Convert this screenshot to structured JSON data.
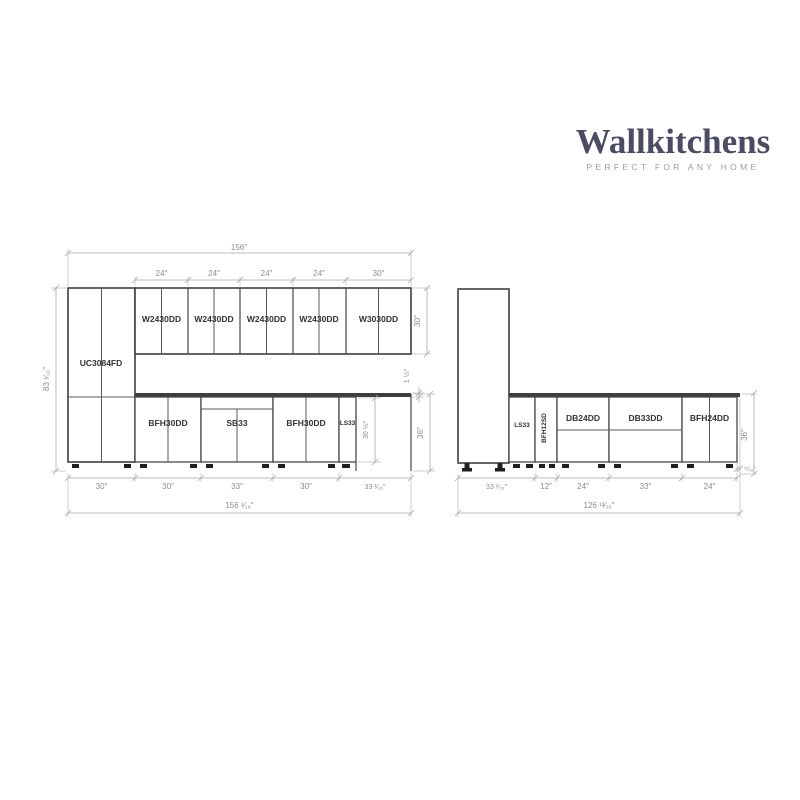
{
  "logo": {
    "brand": "Wallkitchens",
    "tagline": "PERFECT FOR ANY HOME"
  },
  "colors": {
    "brand_navy": "#4b4b62",
    "tagline_gray": "#9b9ba3",
    "cabinet_line": "#474747",
    "dimension_gray": "#8c8c8c"
  },
  "left_elevation": {
    "tall_cabinet": {
      "label": "UC3084FD"
    },
    "wall_cabinets": [
      {
        "label": "W2430DD"
      },
      {
        "label": "W2430DD"
      },
      {
        "label": "W2430DD"
      },
      {
        "label": "W2430DD"
      },
      {
        "label": "W3030DD"
      }
    ],
    "base_cabinets": [
      {
        "label": "BFH30DD"
      },
      {
        "label": "SB33"
      },
      {
        "label": "BFH30DD"
      },
      {
        "label": "LS33"
      }
    ],
    "dims": {
      "overall_width_top": "156″",
      "wall_widths": [
        "24″",
        "24″",
        "24″",
        "24″",
        "30″"
      ],
      "wall_height": "30″",
      "total_height": "83 ¹⁄₁₆″",
      "countertop_thickness": "1 ½″",
      "base_height": "30 ½″",
      "counter_height": "36″",
      "base_widths": [
        "30″",
        "30″",
        "33″",
        "30″",
        "33 ¹⁄₁₆″"
      ],
      "overall_width_bottom": "156 ¹⁄₁₆″"
    }
  },
  "right_elevation": {
    "base_cabinets": [
      {
        "label": "LS33"
      },
      {
        "label": "BFH12SD"
      },
      {
        "label": "DB24DD"
      },
      {
        "label": "DB33DD"
      },
      {
        "label": "BFH24DD"
      }
    ],
    "dims": {
      "base_widths": [
        "33 ¹⁄₁₆″",
        "12″",
        "24″",
        "33″",
        "24″"
      ],
      "counter_overhang": "¹¹⁄₁₆″",
      "overall_width_bottom": "126 ¹³⁄₁₆″",
      "counter_height": "36″"
    }
  }
}
